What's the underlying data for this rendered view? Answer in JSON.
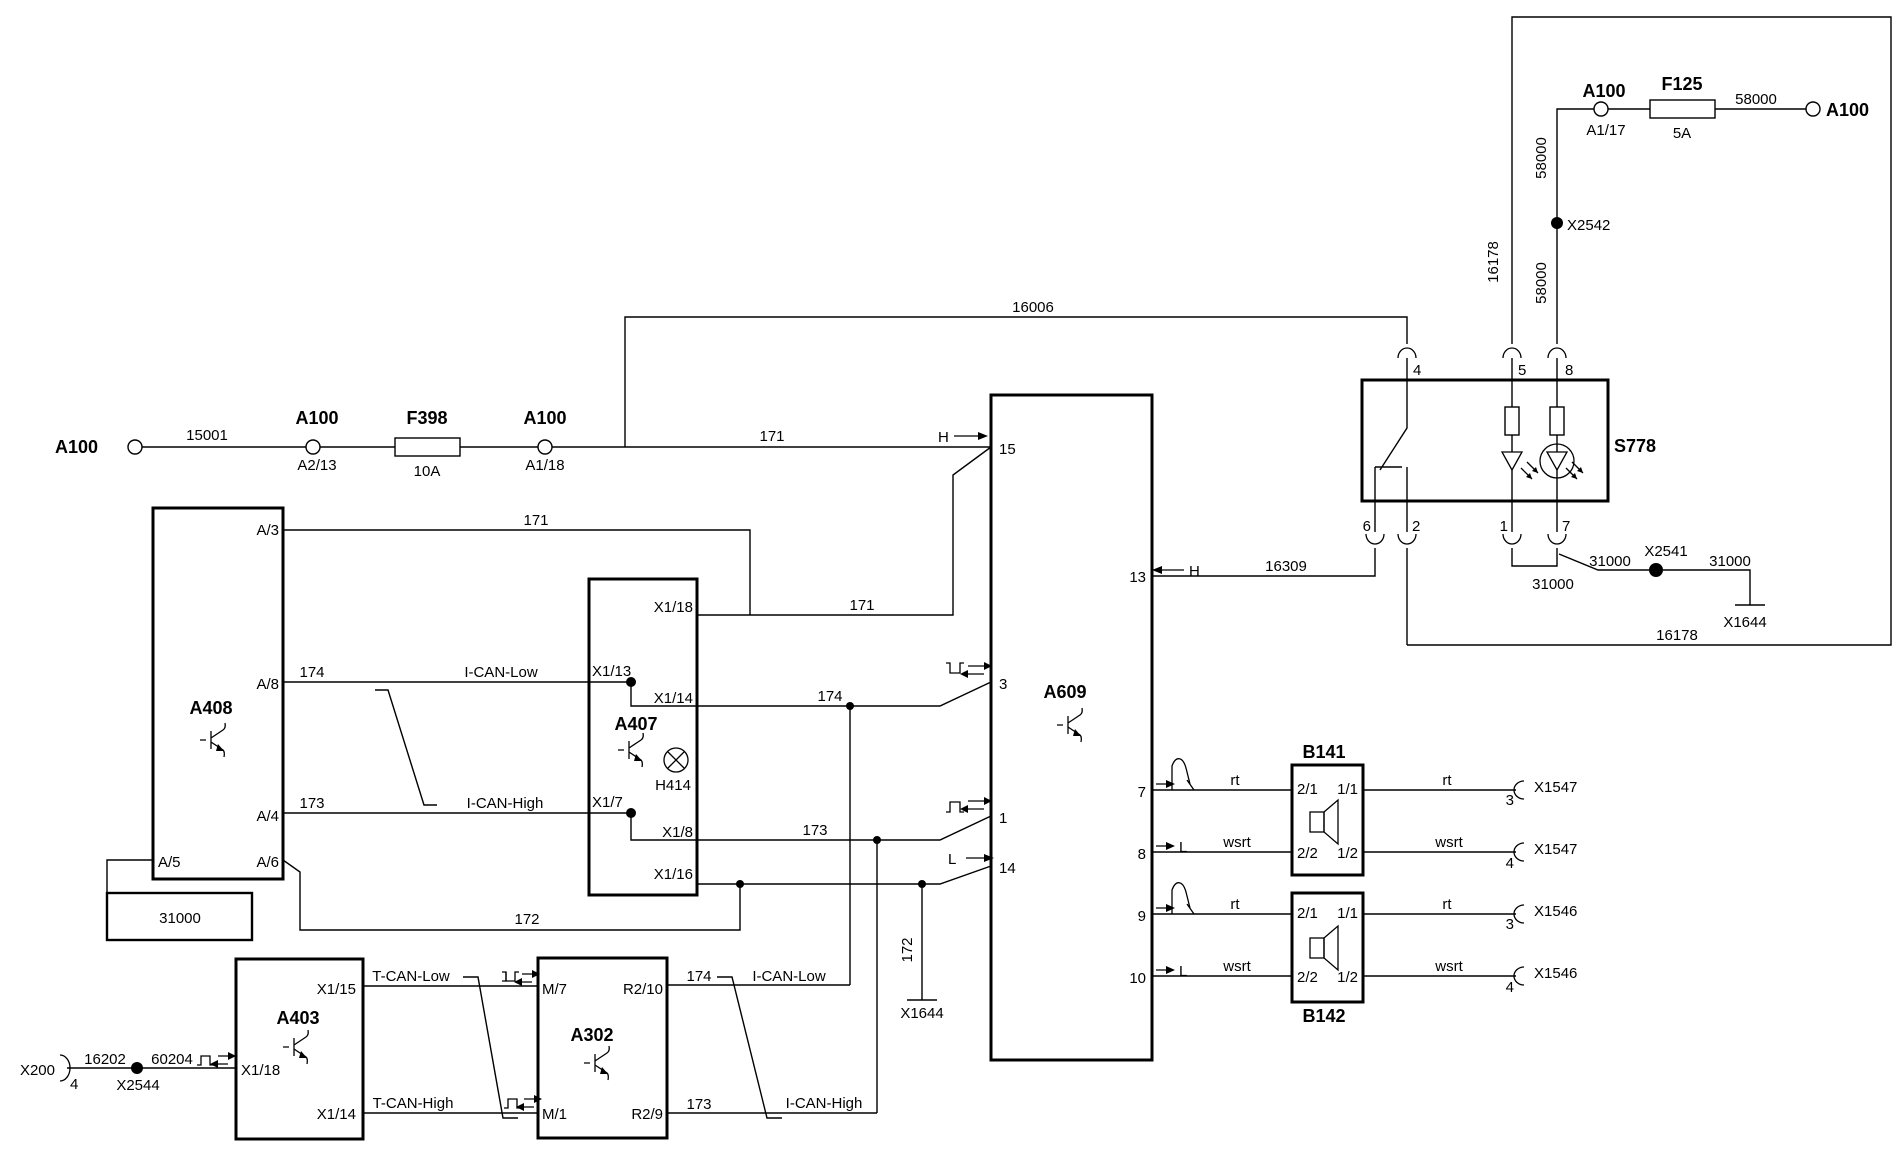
{
  "power": {
    "a100": "A100",
    "w15001": "15001",
    "a2_13": "A2/13",
    "f398": "F398",
    "f398_rating": "10A",
    "a1_18": "A1/18",
    "w171": "171",
    "w16006": "16006",
    "a1_17": "A1/17",
    "f125": "F125",
    "f125_rating": "5A",
    "w58000": "58000",
    "x2542": "X2542",
    "w16178": "16178"
  },
  "a408": {
    "name": "A408",
    "pins": {
      "a3": "A/3",
      "a8": "A/8",
      "a4": "A/4",
      "a5": "A/5",
      "a6": "A/6"
    },
    "ground": "31000"
  },
  "a407": {
    "name": "A407",
    "lamp": "H414",
    "pins": {
      "x1_18": "X1/18",
      "x1_13": "X1/13",
      "x1_14": "X1/14",
      "x1_7": "X1/7",
      "x1_8": "X1/8",
      "x1_16": "X1/16"
    }
  },
  "a609": {
    "name": "A609",
    "pins": {
      "p15": "15",
      "p13": "13",
      "p3": "3",
      "p1": "1",
      "p14": "14",
      "p7": "7",
      "p8": "8",
      "p9": "9",
      "p10": "10"
    },
    "sig_h": "H",
    "sig_l": "L"
  },
  "canbus": {
    "i_can_low": "I-CAN-Low",
    "i_can_high": "I-CAN-High",
    "t_can_low": "T-CAN-Low",
    "t_can_high": "T-CAN-High",
    "w174": "174",
    "w173": "173",
    "w172": "172"
  },
  "s778": {
    "name": "S778",
    "pins": {
      "p4": "4",
      "p5": "5",
      "p8": "8",
      "p6": "6",
      "p2": "2",
      "p1": "1",
      "p7": "7"
    }
  },
  "grounds": {
    "w31000": "31000",
    "x2541": "X2541",
    "x1644": "X1644",
    "w16309": "16309"
  },
  "speakers": {
    "b141": "B141",
    "b142": "B142",
    "p21": "2/1",
    "p11": "1/1",
    "p22": "2/2",
    "p12": "1/2",
    "rt": "rt",
    "wsrt": "wsrt",
    "x1547": "X1547",
    "x1546": "X1546",
    "p3": "3",
    "p4": "4"
  },
  "bottom": {
    "x200": "X200",
    "p4": "4",
    "w16202": "16202",
    "x2544": "X2544",
    "w60204": "60204",
    "a403": "A403",
    "x1_15": "X1/15",
    "x1_18": "X1/18",
    "x1_14": "X1/14",
    "a302": "A302",
    "m7": "M/7",
    "m1": "M/1",
    "r2_10": "R2/10",
    "r2_9": "R2/9"
  }
}
